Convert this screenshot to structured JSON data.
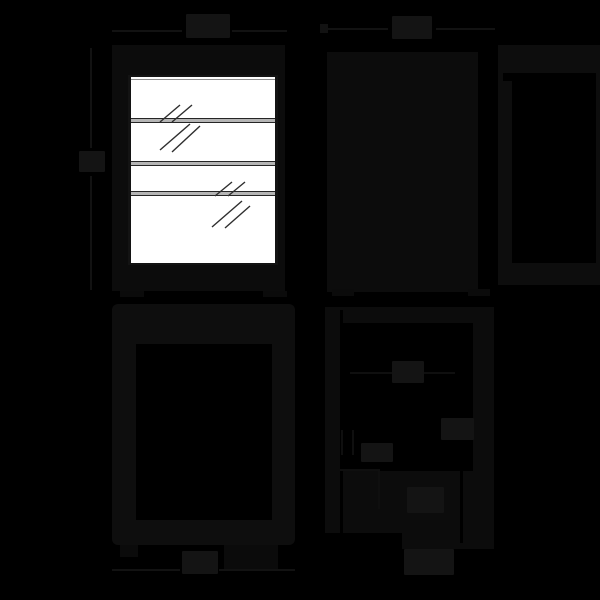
{
  "page": {
    "kind": "appliance dimension drawing, four orthographic views on black background",
    "background_color": "#000000"
  },
  "colors": {
    "background": "#000000",
    "faint_line": "#121212",
    "body_fill": "#0c0c0c",
    "label_blob": "#141414",
    "door_glass": "#ffffff",
    "shelf_fill": "#b5b5b5",
    "shelf_edge": "#262626",
    "hatch_stroke": "#2e2e2e"
  },
  "views": {
    "front": {
      "dim_top_label": "",
      "dim_left_label": "",
      "shelf_count": 3
    },
    "side": {
      "dim_top_label": ""
    },
    "back": {
      "dim_bottom_label": ""
    },
    "detail": {
      "dim_label_1": "",
      "dim_label_2": "",
      "dim_label_3": "",
      "dim_label_4": "",
      "dim_bottom_label": ""
    }
  }
}
